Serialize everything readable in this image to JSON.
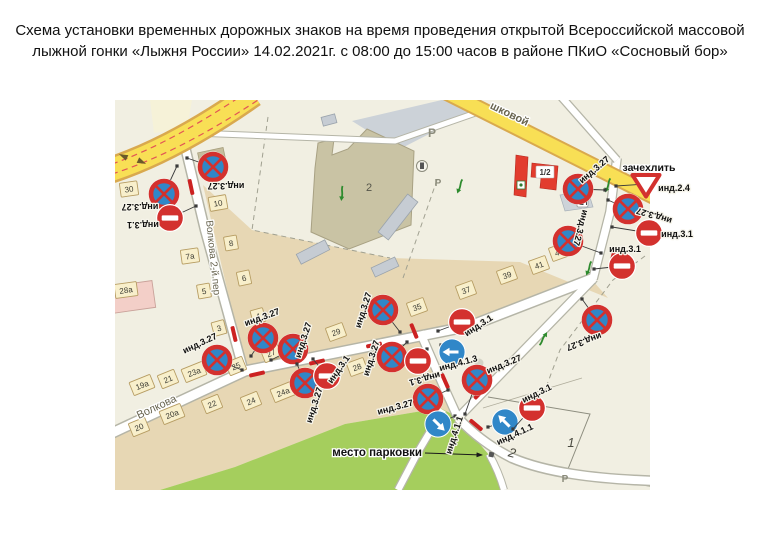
{
  "title": {
    "line1": "Схема установки временных дорожных знаков на время проведения открытой Всероссийской массовой",
    "line2": "лыжной гонки «Лыжня России» 14.02.2021г. с 08:00 до 15:00 часов в районе ПКиО «Сосновый бор»"
  },
  "map": {
    "street_labels": [
      {
        "text": "Волкова 2-й пер",
        "x": 210,
        "y": 258,
        "rot": 84,
        "size": 10,
        "weight": 400
      },
      {
        "text": "Волкова",
        "x": 158,
        "y": 410,
        "rot": -25,
        "size": 11,
        "weight": 400
      },
      {
        "text": "шковой",
        "x": 508,
        "y": 117,
        "rot": 26,
        "size": 11,
        "weight": 700
      }
    ],
    "annotations": {
      "cover_label": {
        "text": "зачехлить",
        "x": 649,
        "y": 171
      },
      "parking_label": {
        "text": "место парковки",
        "x": 422,
        "y": 456
      },
      "zone_1": {
        "text": "1",
        "x": 571,
        "y": 447
      },
      "road_2": {
        "text": "2",
        "x": 511,
        "y": 457
      },
      "building_2": {
        "text": "2",
        "x": 369,
        "y": 191
      },
      "building_half": {
        "text": "1/2",
        "x": 545,
        "y": 175
      },
      "p_marks": [
        {
          "x": 432,
          "y": 137,
          "size": 12
        },
        {
          "x": 438,
          "y": 186,
          "size": 10
        },
        {
          "x": 565,
          "y": 482,
          "size": 10
        }
      ]
    },
    "sign_types": {
      "ns": "no-stopping-sign-3.27",
      "ne": "no-entry-sign-3.1",
      "dl": "direction-left-sign-4.1.3",
      "d1": "direction-sign-4.1.1",
      "d2": "direction-sign-4.1.1",
      "gw": "give-way-sign-2.4"
    },
    "signs": [
      {
        "t": "ns",
        "x": 213,
        "y": 167,
        "lbl": "инд.3.27",
        "lx": 226,
        "ly": 183,
        "lr": 180,
        "px": 187,
        "py": 158
      },
      {
        "t": "ns",
        "x": 164,
        "y": 194,
        "lbl": "инд.3.27",
        "lx": 140,
        "ly": 204,
        "lr": 180,
        "px": 177,
        "py": 166
      },
      {
        "t": "ne",
        "x": 170,
        "y": 218,
        "lbl": "инд.3.1",
        "lx": 143,
        "ly": 222,
        "lr": 180,
        "px": 196,
        "py": 206
      },
      {
        "t": "ns",
        "x": 578,
        "y": 189,
        "lbl": "инд.3.27",
        "lx": 596,
        "ly": 172,
        "lr": -40,
        "px": 605,
        "py": 190
      },
      {
        "t": "gw",
        "x": 646,
        "y": 184,
        "lbl": "инд.2.4",
        "lx": 674,
        "ly": 191,
        "lr": 0,
        "px": 616,
        "py": 186
      },
      {
        "t": "ns",
        "x": 628,
        "y": 209,
        "lbl": "инд.3.27",
        "lx": 655,
        "ly": 213,
        "lr": 197,
        "px": 608,
        "py": 200
      },
      {
        "t": "ne",
        "x": 649,
        "y": 233,
        "lbl": "инд.3.1",
        "lx": 677,
        "ly": 237,
        "lr": 0,
        "px": 612,
        "py": 227
      },
      {
        "t": "ns",
        "x": 568,
        "y": 241,
        "lbl": "инд.3.27",
        "lx": 578,
        "ly": 227,
        "lr": 105,
        "px": 601,
        "py": 253
      },
      {
        "t": "ne",
        "x": 622,
        "y": 266,
        "lbl": "инд.3.1",
        "lx": 625,
        "ly": 252,
        "lr": 0,
        "px": 594,
        "py": 269
      },
      {
        "t": "ns",
        "x": 597,
        "y": 320,
        "lbl": "инд.3.27",
        "lx": 583,
        "ly": 339,
        "lr": 160,
        "px": 582,
        "py": 299
      },
      {
        "t": "ns",
        "x": 217,
        "y": 360,
        "lbl": "инд.3.27",
        "lx": 201,
        "ly": 346,
        "lr": -25,
        "px": 242,
        "py": 370
      },
      {
        "t": "ns",
        "x": 263,
        "y": 338,
        "lbl": "инд.3.27",
        "lx": 263,
        "ly": 320,
        "lr": -20,
        "px": 251,
        "py": 356
      },
      {
        "t": "ns",
        "x": 293,
        "y": 349,
        "lbl": "инд.3.27",
        "lx": 306,
        "ly": 341,
        "lr": -72,
        "px": 271,
        "py": 360
      },
      {
        "t": "ns",
        "x": 305,
        "y": 383,
        "lbl": "инд.3.27",
        "lx": 317,
        "ly": 406,
        "lr": -72,
        "px": 297,
        "py": 364
      },
      {
        "t": "ne",
        "x": 327,
        "y": 376,
        "lbl": "инд.3.1",
        "lx": 341,
        "ly": 371,
        "lr": -55,
        "px": 313,
        "py": 359
      },
      {
        "t": "ns",
        "x": 383,
        "y": 310,
        "lbl": "инд.3.27",
        "lx": 366,
        "ly": 311,
        "lr": -72,
        "px": 400,
        "py": 332
      },
      {
        "t": "ns",
        "x": 392,
        "y": 357,
        "lbl": "инд.3.27",
        "lx": 374,
        "ly": 359,
        "lr": -72,
        "px": 407,
        "py": 342
      },
      {
        "t": "ne",
        "x": 418,
        "y": 361,
        "lbl": "инд.3.1",
        "lx": 424,
        "ly": 376,
        "lr": 165,
        "px": 427,
        "py": 349
      },
      {
        "t": "ne",
        "x": 462,
        "y": 322,
        "lbl": "инд.3.1",
        "lx": 480,
        "ly": 328,
        "lr": -33,
        "px": 438,
        "py": 331
      },
      {
        "t": "dl",
        "x": 452,
        "y": 352,
        "lbl": "инд.4.1.3",
        "lx": 459,
        "ly": 366,
        "lr": -15,
        "px": 441,
        "py": 345
      },
      {
        "t": "ns",
        "x": 477,
        "y": 380,
        "lbl": "инд.3.27",
        "lx": 505,
        "ly": 367,
        "lr": -22,
        "px": 465,
        "py": 414
      },
      {
        "t": "ns",
        "x": 428,
        "y": 399,
        "lbl": "инд.3.27",
        "lx": 396,
        "ly": 410,
        "lr": -15,
        "px": 448,
        "py": 390
      },
      {
        "t": "d1",
        "x": 438,
        "y": 424,
        "lbl": "инд.4.1.1",
        "lx": 457,
        "ly": 436,
        "lr": -72,
        "px": 455,
        "py": 416
      },
      {
        "t": "d2",
        "x": 505,
        "y": 422,
        "lbl": "инд.4.1.1",
        "lx": 516,
        "ly": 437,
        "lr": -25,
        "px": 488,
        "py": 427
      },
      {
        "t": "ne",
        "x": 532,
        "y": 408,
        "lbl": "инд.3.1",
        "lx": 538,
        "ly": 396,
        "lr": -26,
        "px": 513,
        "py": 429
      }
    ],
    "buildings": [
      {
        "n": "30",
        "x": 129,
        "y": 189,
        "r": -8
      },
      {
        "n": "10",
        "x": 218,
        "y": 203,
        "r": -10
      },
      {
        "n": "8",
        "x": 231,
        "y": 243,
        "r": -10
      },
      {
        "n": "7а",
        "x": 190,
        "y": 256,
        "r": -8
      },
      {
        "n": "6",
        "x": 244,
        "y": 278,
        "r": -12
      },
      {
        "n": "5",
        "x": 204,
        "y": 291,
        "r": -10
      },
      {
        "n": "3",
        "x": 219,
        "y": 328,
        "r": -15
      },
      {
        "n": "4",
        "x": 258,
        "y": 316,
        "r": -15
      },
      {
        "n": "28а",
        "x": 126,
        "y": 290,
        "r": -8
      },
      {
        "n": "23а",
        "x": 194,
        "y": 372,
        "r": -22
      },
      {
        "n": "21",
        "x": 168,
        "y": 379,
        "r": -22
      },
      {
        "n": "19а",
        "x": 142,
        "y": 385,
        "r": -22
      },
      {
        "n": "20а",
        "x": 172,
        "y": 414,
        "r": -22
      },
      {
        "n": "20",
        "x": 139,
        "y": 427,
        "r": -22
      },
      {
        "n": "22",
        "x": 212,
        "y": 404,
        "r": -22
      },
      {
        "n": "24",
        "x": 251,
        "y": 401,
        "r": -22
      },
      {
        "n": "24а",
        "x": 283,
        "y": 392,
        "r": -22
      },
      {
        "n": "25",
        "x": 236,
        "y": 366,
        "r": -22
      },
      {
        "n": "27",
        "x": 271,
        "y": 353,
        "r": -22
      },
      {
        "n": "29",
        "x": 336,
        "y": 332,
        "r": -20
      },
      {
        "n": "28",
        "x": 357,
        "y": 367,
        "r": -20
      },
      {
        "n": "35",
        "x": 417,
        "y": 307,
        "r": -20
      },
      {
        "n": "37",
        "x": 466,
        "y": 290,
        "r": -20
      },
      {
        "n": "39",
        "x": 507,
        "y": 275,
        "r": -20
      },
      {
        "n": "41",
        "x": 539,
        "y": 265,
        "r": -20
      },
      {
        "n": "43",
        "x": 559,
        "y": 252,
        "r": -20
      }
    ],
    "red_bars": [
      [
        191,
        187,
        78
      ],
      [
        234,
        334,
        77
      ],
      [
        317,
        362,
        -13
      ],
      [
        374,
        345,
        -12
      ],
      [
        257,
        374,
        -13
      ],
      [
        414,
        331,
        68
      ],
      [
        445,
        381,
        66
      ],
      [
        476,
        425,
        40
      ],
      [
        480,
        393,
        -46
      ],
      [
        612,
        260,
        105
      ]
    ],
    "green_arrows": [
      [
        460,
        186,
        200
      ],
      [
        342,
        193,
        185
      ],
      [
        608,
        185,
        200
      ],
      [
        589,
        268,
        200
      ],
      [
        543,
        339,
        30
      ]
    ],
    "road_arrows": [
      [
        123,
        156,
        205
      ],
      [
        142,
        162,
        25
      ]
    ],
    "colors": {
      "cream": "#f1efe2",
      "tan": "#e7d7b4",
      "green": "#a5ce5d",
      "yellow": "#f8df55",
      "yellow_edge": "#d9a94e",
      "road": "#ffffff",
      "road_edge": "#b5b5a7",
      "sign_red": "#d3312e",
      "sign_blue": "#3087c8",
      "bldg_fill": "#f8efcb",
      "bldg_edge": "#b69c62",
      "gray": "#c9cfd6",
      "red_bldg": "#e23c2e",
      "pink": "#f3cfc8"
    }
  }
}
